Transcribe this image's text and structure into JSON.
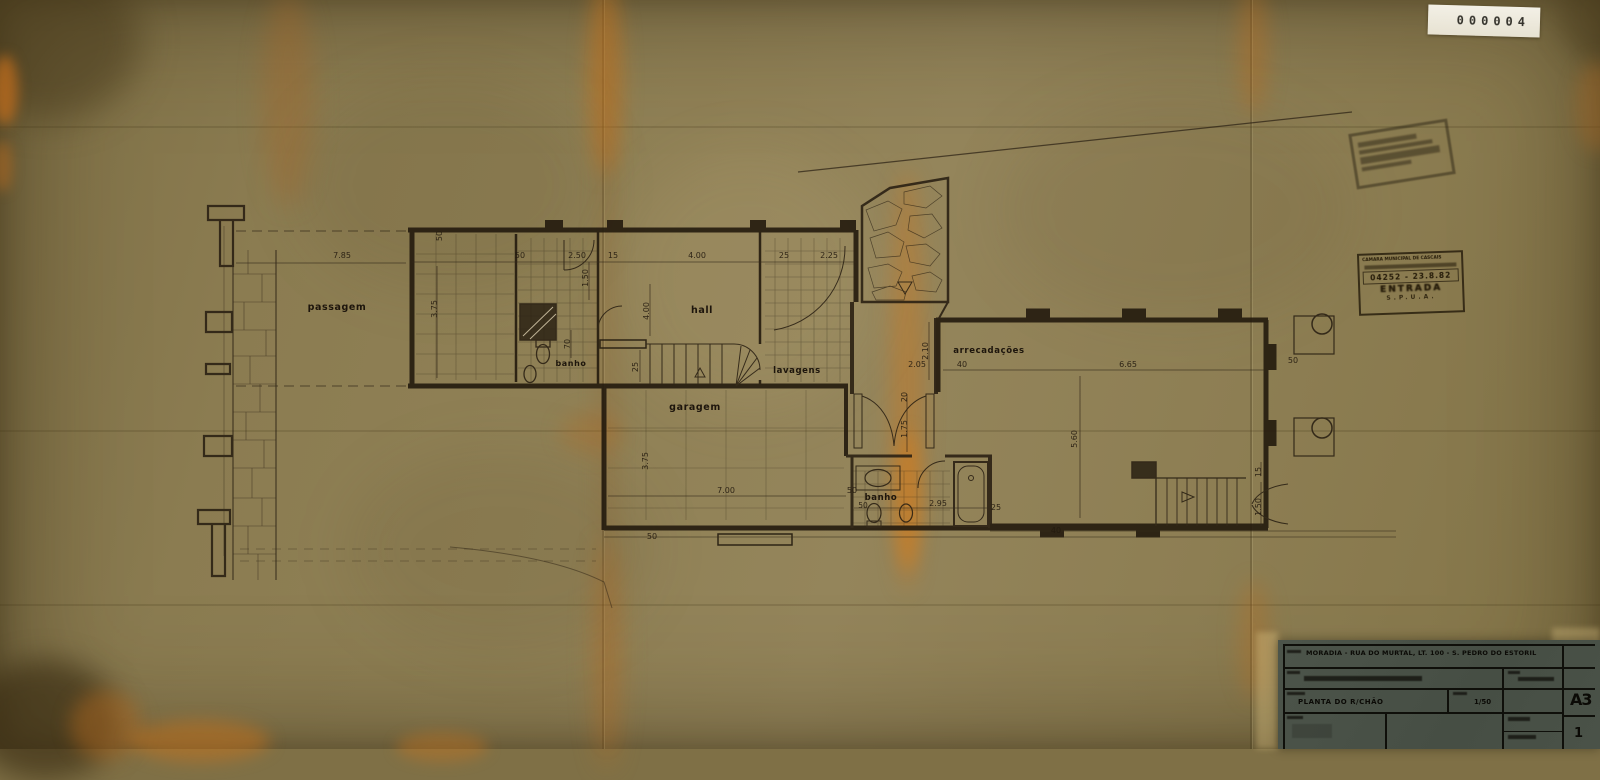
{
  "document": {
    "sticker_number": "000004",
    "entry_stamp": {
      "line1": "CÂMARA MUNICIPAL DE CASCAIS",
      "line2": "04252 - 23.8.82",
      "line3": "ENTRADA",
      "line4": "S.P.U.A."
    },
    "title_block": {
      "project": "MORADIA - RUA DO MURTAL, LT. 100 - S. PEDRO DO ESTORIL",
      "drawing_title": "PLANTA DO R/CHÃO",
      "scale": "1/50",
      "sheet_format": "A3",
      "sheet_number": "1"
    }
  },
  "plan": {
    "rooms": [
      {
        "label": "passagem"
      },
      {
        "label": "banho"
      },
      {
        "label": "hall"
      },
      {
        "label": "lavagens"
      },
      {
        "label": "garagem"
      },
      {
        "label": "arrecadações"
      },
      {
        "label": "banho"
      }
    ],
    "dims": [
      {
        "t": "7.85"
      },
      {
        "t": "50"
      },
      {
        "t": "2.50"
      },
      {
        "t": "15"
      },
      {
        "t": "4.00"
      },
      {
        "t": "25"
      },
      {
        "t": "2.25"
      },
      {
        "t": "50"
      },
      {
        "t": "3.75"
      },
      {
        "t": "1.50"
      },
      {
        "t": "4.00"
      },
      {
        "t": "25"
      },
      {
        "t": "70"
      },
      {
        "t": "2.05"
      },
      {
        "t": "2.10"
      },
      {
        "t": "40"
      },
      {
        "t": "6.65"
      },
      {
        "t": "50"
      },
      {
        "t": "20"
      },
      {
        "t": "1.75"
      },
      {
        "t": "3.75"
      },
      {
        "t": "7.00"
      },
      {
        "t": "50"
      },
      {
        "t": "50"
      },
      {
        "t": "50"
      },
      {
        "t": "2.95"
      },
      {
        "t": "25"
      },
      {
        "t": "5.60"
      },
      {
        "t": "15"
      },
      {
        "t": "1.50"
      },
      {
        "t": "40"
      }
    ]
  }
}
